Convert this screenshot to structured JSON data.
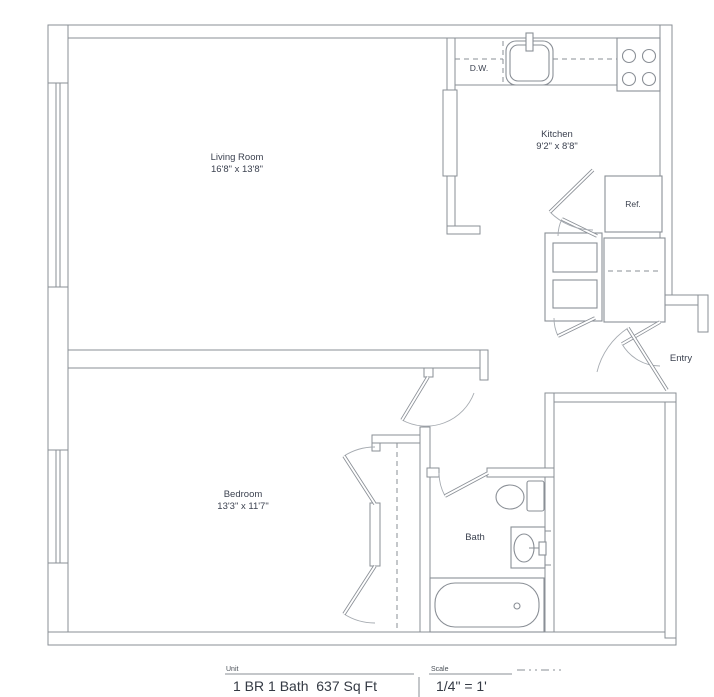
{
  "rooms": {
    "living_room": {
      "name": "Living Room",
      "dims": "16'8\" x 13'8\""
    },
    "kitchen": {
      "name": "Kitchen",
      "dims": "9'2\" x 8'8\""
    },
    "bedroom": {
      "name": "Bedroom",
      "dims": "13'3\" x 11'7\""
    },
    "bath": {
      "name": "Bath"
    },
    "entry": {
      "name": "Entry"
    }
  },
  "appliances": {
    "dishwasher": "D.W.",
    "refrigerator": "Ref."
  },
  "legend": {
    "unit_label": "Unit",
    "unit_value": "1 BR 1 Bath  637 Sq Ft",
    "scale_label": "Scale",
    "scale_value": "1/4\" = 1'"
  },
  "colors": {
    "wall_line": "#8a8f96",
    "text": "#3c4250",
    "legend_text": "#343a44",
    "background": "#ffffff"
  }
}
